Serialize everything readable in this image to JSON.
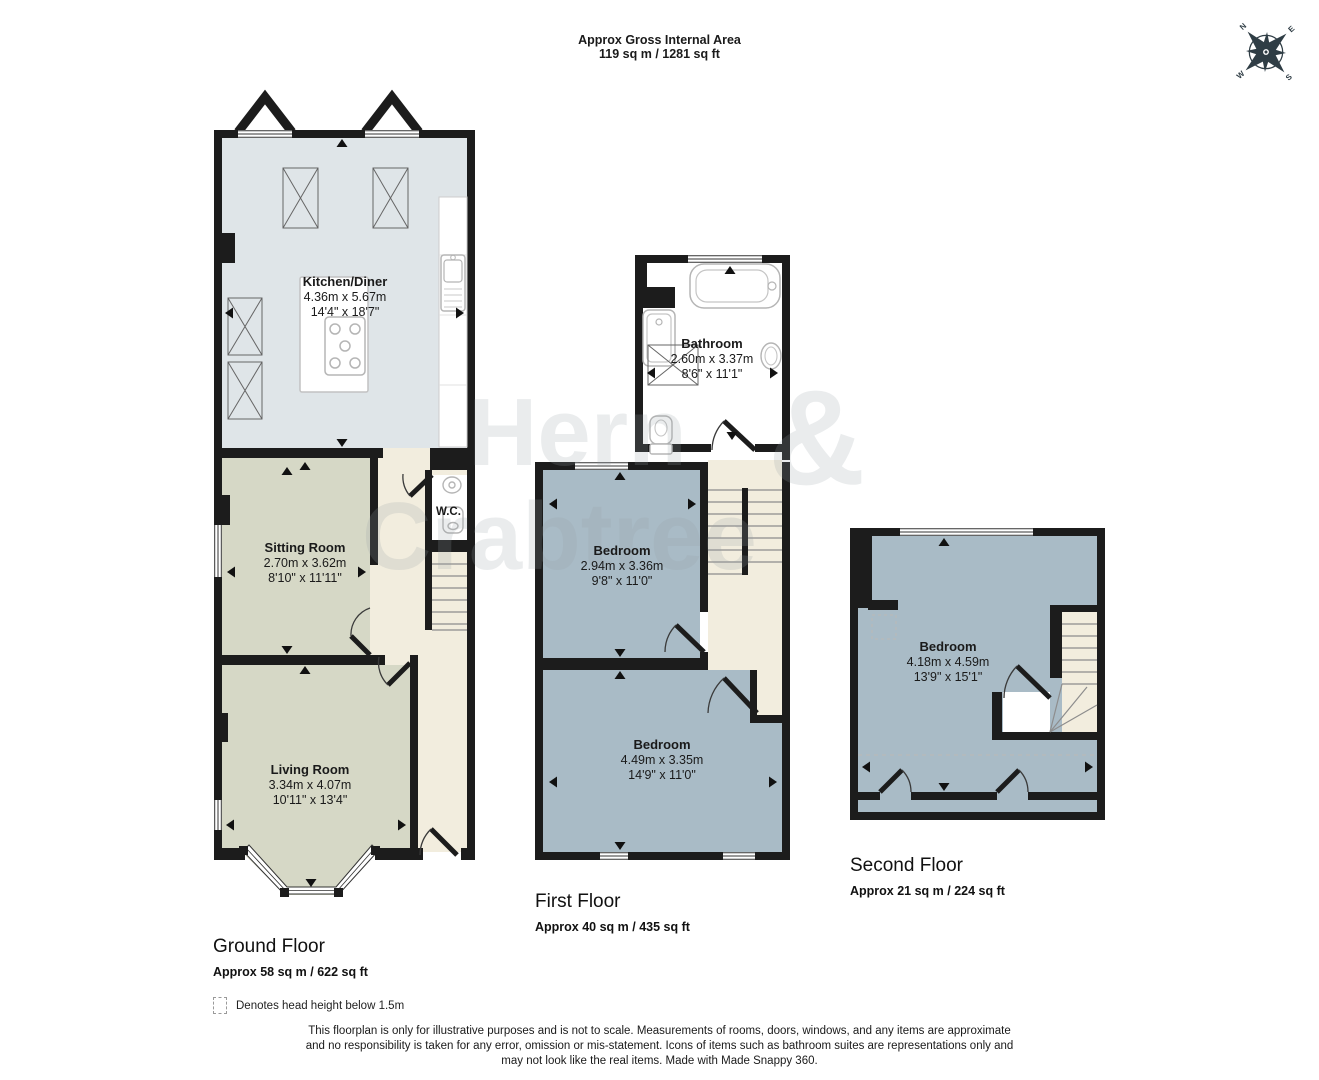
{
  "page": {
    "title_line1": "Approx Gross Internal Area",
    "title_line2": "119 sq m / 1281 sq ft"
  },
  "compass": {
    "n": "N",
    "e": "E",
    "s": "S",
    "w": "W"
  },
  "watermark": {
    "word1": "Hern",
    "ampersand": "&",
    "word2": "Crabtree"
  },
  "floors": {
    "ground": {
      "caption": "Ground Floor",
      "area": "Approx 58 sq m / 622 sq ft",
      "rooms": {
        "kitchen": {
          "name": "Kitchen/Diner",
          "metric": "4.36m x 5.67m",
          "imperial": "14'4\" x 18'7\""
        },
        "sitting": {
          "name": "Sitting Room",
          "metric": "2.70m x 3.62m",
          "imperial": "8'10\" x 11'11\""
        },
        "living": {
          "name": "Living Room",
          "metric": "3.34m x 4.07m",
          "imperial": "10'11\" x 13'4\""
        },
        "wc": {
          "name": "W.C."
        }
      }
    },
    "first": {
      "caption": "First Floor",
      "area": "Approx 40 sq m / 435 sq ft",
      "rooms": {
        "bathroom": {
          "name": "Bathroom",
          "metric": "2.60m x 3.37m",
          "imperial": "8'6\" x 11'1\""
        },
        "bedroom1": {
          "name": "Bedroom",
          "metric": "2.94m x 3.36m",
          "imperial": "9'8\" x 11'0\""
        },
        "bedroom2": {
          "name": "Bedroom",
          "metric": "4.49m x 3.35m",
          "imperial": "14'9\" x 11'0\""
        }
      }
    },
    "second": {
      "caption": "Second Floor",
      "area": "Approx 21 sq m / 224 sq ft",
      "rooms": {
        "bedroom": {
          "name": "Bedroom",
          "metric": "4.18m x 4.59m",
          "imperial": "13'9\" x 15'1\""
        }
      }
    }
  },
  "legend": {
    "text": "Denotes head height below 1.5m"
  },
  "disclaimer": {
    "line1": "This floorplan is only for illustrative purposes and is not to scale. Measurements of rooms, doors, windows, and any items are approximate",
    "line2": "and no responsibility is taken for any error, omission or mis-statement. Icons of items such as bathroom suites are representations only and",
    "line3": "may not look like the real items. Made with Made Snappy 360."
  },
  "colors": {
    "wall": "#1c1c1c",
    "kitchen_floor": "#dfe5e8",
    "lounge_floor": "#d6d8c6",
    "hall_floor": "#f2edde",
    "bedroom_floor": "#a9bbc6",
    "bathroom_floor": "#ffffff"
  }
}
